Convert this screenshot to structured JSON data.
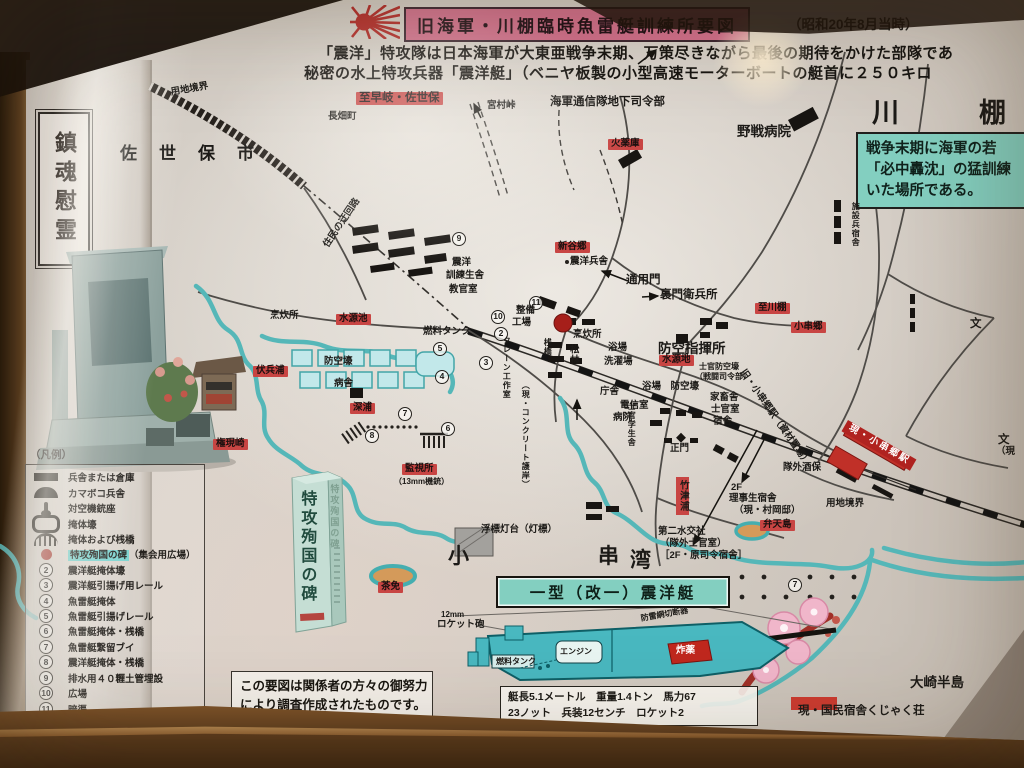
{
  "header": {
    "title": "旧海軍・川棚臨時魚雷艇訓練所要図",
    "date_note": "（昭和20年8月当時）",
    "intro_line1": "「震洋」特攻隊は日本海軍が大東亜戦争末期、万策尽きながら最後の期待をかけた部隊であ",
    "intro_line2": "秘密の水上特攻兵器「震洋艇」（ベニヤ板製の小型高速モーターボートの艇首に２５０キロ",
    "flag_icon": "rising-sun-icon"
  },
  "left_panel": {
    "plaque": "鎮魂慰霊"
  },
  "info_box": {
    "lines": [
      "戦争末期に海軍の若",
      "「必中轟沈」の猛訓練",
      "いた場所である。"
    ]
  },
  "legend": {
    "title": "（凡例）",
    "items": [
      {
        "icon": "ic-bar",
        "label": "兵舎または倉庫"
      },
      {
        "icon": "ic-arc",
        "label": "カマボコ兵舎"
      },
      {
        "icon": "ic-gun",
        "label": "対空機銃座"
      },
      {
        "icon": "ic-bunker",
        "label": "掩体壕"
      },
      {
        "icon": "ic-pier",
        "label": "掩体および桟橋"
      },
      {
        "icon": "ic-reddot",
        "label": "特攻殉国の碑",
        "suffix": "（集会用広場）",
        "highlight": true
      },
      {
        "num": "2",
        "label": "震洋艇掩体壕"
      },
      {
        "num": "3",
        "label": "震洋艇引揚げ用レール"
      },
      {
        "num": "4",
        "label": "魚雷艇掩体"
      },
      {
        "num": "5",
        "label": "魚雷艇引揚げレール"
      },
      {
        "num": "6",
        "label": "魚雷艇掩体・桟橋"
      },
      {
        "num": "7",
        "label": "魚雷艇繋留ブイ"
      },
      {
        "num": "8",
        "label": "震洋艇掩体・桟橋"
      },
      {
        "num": "9",
        "label": "排水用４０糎土管埋設"
      },
      {
        "num": "10",
        "label": "広場"
      },
      {
        "num": "11",
        "label": "暗渠"
      }
    ]
  },
  "map": {
    "accent_colors": {
      "red_label": "#c84543",
      "teal_water": "#55b7b8",
      "green_box": "#83cfc0",
      "title_pink": "#d4718d"
    },
    "labels": [
      {
        "t": "用地境界",
        "x": 170,
        "y": 88,
        "c": "xs",
        "r": -10
      },
      {
        "t": "長畑町",
        "x": 328,
        "y": 112,
        "c": "xs"
      },
      {
        "t": "至早岐・佐世保",
        "x": 356,
        "y": 92,
        "c": "red sm"
      },
      {
        "t": "宮村峠",
        "x": 487,
        "y": 101,
        "c": "xs"
      },
      {
        "t": "佐世保市",
        "x": 120,
        "y": 144,
        "c": "sp1"
      },
      {
        "t": "海軍通信隊地下司令部",
        "x": 550,
        "y": 96,
        "c": "sm"
      },
      {
        "t": "火薬庫",
        "x": 608,
        "y": 139,
        "c": "red xs"
      },
      {
        "t": "野戦病院",
        "x": 737,
        "y": 124,
        "c": "md"
      },
      {
        "t": "川棚",
        "x": 872,
        "y": 98,
        "c": "sp2"
      },
      {
        "t": "施設兵宿舎",
        "x": 851,
        "y": 202,
        "c": "vert xxs"
      },
      {
        "t": "住民の迂回路",
        "x": 322,
        "y": 244,
        "c": "xs",
        "r": -56
      },
      {
        "t": "9",
        "x": 452,
        "y": 232,
        "c": "circ"
      },
      {
        "t": "新谷郷",
        "x": 555,
        "y": 242,
        "c": "red xs"
      },
      {
        "t": "震洋兵舎",
        "x": 570,
        "y": 257,
        "c": "xs"
      },
      {
        "t": "震洋",
        "x": 452,
        "y": 258,
        "c": "xs"
      },
      {
        "t": "訓練生舎",
        "x": 446,
        "y": 271,
        "c": "xs"
      },
      {
        "t": "教官室",
        "x": 449,
        "y": 285,
        "c": "xs"
      },
      {
        "t": "通用門",
        "x": 626,
        "y": 274,
        "c": "sm"
      },
      {
        "t": "裏門衛兵所",
        "x": 660,
        "y": 289,
        "c": "sm"
      },
      {
        "t": "11",
        "x": 529,
        "y": 296,
        "c": "circ"
      },
      {
        "t": "整備",
        "x": 516,
        "y": 306,
        "c": "xs"
      },
      {
        "t": "工場",
        "x": 512,
        "y": 318,
        "c": "xs"
      },
      {
        "t": "10",
        "x": 491,
        "y": 310,
        "c": "circ"
      },
      {
        "t": "燃料タンク",
        "x": 423,
        "y": 327,
        "c": "xs"
      },
      {
        "t": "5",
        "x": 433,
        "y": 342,
        "c": "circ"
      },
      {
        "t": "2",
        "x": 494,
        "y": 327,
        "c": "circ"
      },
      {
        "t": "3",
        "x": 479,
        "y": 356,
        "c": "circ"
      },
      {
        "t": "4",
        "x": 435,
        "y": 370,
        "c": "circ"
      },
      {
        "t": "クレーン工作室",
        "x": 502,
        "y": 336,
        "c": "vert xxs"
      },
      {
        "t": "桟橋",
        "x": 543,
        "y": 338,
        "c": "vert xxs"
      },
      {
        "t": "松林",
        "x": 567,
        "y": 344,
        "c": "vert xs"
      },
      {
        "t": "（現・コンクリート護岸）",
        "x": 521,
        "y": 381,
        "c": "vert xxs"
      },
      {
        "t": "烹炊所",
        "x": 270,
        "y": 311,
        "c": "xs"
      },
      {
        "t": "水源池",
        "x": 336,
        "y": 314,
        "c": "red xs"
      },
      {
        "t": "伏兵浦",
        "x": 253,
        "y": 366,
        "c": "red xs"
      },
      {
        "t": "防空壕",
        "x": 324,
        "y": 357,
        "c": "xs"
      },
      {
        "t": "病舎",
        "x": 334,
        "y": 379,
        "c": "xs"
      },
      {
        "t": "深浦",
        "x": 350,
        "y": 403,
        "c": "red xs"
      },
      {
        "t": "権現崎",
        "x": 213,
        "y": 439,
        "c": "red xs"
      },
      {
        "t": "烹炊所",
        "x": 573,
        "y": 330,
        "c": "xs"
      },
      {
        "t": "浴場",
        "x": 608,
        "y": 343,
        "c": "xs"
      },
      {
        "t": "洗濯場",
        "x": 604,
        "y": 357,
        "c": "xs"
      },
      {
        "t": "防空指揮所",
        "x": 658,
        "y": 341,
        "c": "md"
      },
      {
        "t": "水源地",
        "x": 659,
        "y": 355,
        "c": "red xs"
      },
      {
        "t": "士官防空壕",
        "x": 699,
        "y": 362,
        "c": "xxs"
      },
      {
        "t": "（戦闘司令部）",
        "x": 695,
        "y": 372,
        "c": "xxs"
      },
      {
        "t": "浴場　防空壕",
        "x": 642,
        "y": 382,
        "c": "xs"
      },
      {
        "t": "庁舎",
        "x": 600,
        "y": 387,
        "c": "xs"
      },
      {
        "t": "電信室",
        "x": 620,
        "y": 401,
        "c": "xs"
      },
      {
        "t": "病院",
        "x": 613,
        "y": 413,
        "c": "xs"
      },
      {
        "t": "家畜舎",
        "x": 710,
        "y": 393,
        "c": "xs"
      },
      {
        "t": "士官室",
        "x": 711,
        "y": 405,
        "c": "xs"
      },
      {
        "t": "宿舎",
        "x": 713,
        "y": 417,
        "c": "xs"
      },
      {
        "t": "士官学生舎",
        "x": 627,
        "y": 402,
        "c": "vert xxs"
      },
      {
        "t": "正門",
        "x": 670,
        "y": 444,
        "c": "xs"
      },
      {
        "t": "7",
        "x": 398,
        "y": 407,
        "c": "circ"
      },
      {
        "t": "8",
        "x": 365,
        "y": 429,
        "c": "circ"
      },
      {
        "t": "6",
        "x": 441,
        "y": 422,
        "c": "circ"
      },
      {
        "t": "監視所",
        "x": 402,
        "y": 464,
        "c": "red xs"
      },
      {
        "t": "（13mm機銃）",
        "x": 394,
        "y": 477,
        "c": "xxs"
      },
      {
        "t": "浮標灯台（灯標）",
        "x": 481,
        "y": 525,
        "c": "xs"
      },
      {
        "t": "小",
        "x": 448,
        "y": 545,
        "c": "lg"
      },
      {
        "t": "串",
        "x": 598,
        "y": 545,
        "c": "lg"
      },
      {
        "t": "湾",
        "x": 630,
        "y": 549,
        "c": "lg"
      },
      {
        "t": "竹津浦",
        "x": 676,
        "y": 477,
        "c": "vert red-v xs"
      },
      {
        "t": "第二水交社",
        "x": 658,
        "y": 527,
        "c": "xs"
      },
      {
        "t": "（隊外士官室）",
        "x": 660,
        "y": 539,
        "c": "xs"
      },
      {
        "t": "［2F・原司令宿舎］",
        "x": 660,
        "y": 551,
        "c": "xs"
      },
      {
        "t": "2F",
        "x": 731,
        "y": 483,
        "c": "xs"
      },
      {
        "t": "理事生宿舎",
        "x": 729,
        "y": 494,
        "c": "xs"
      },
      {
        "t": "（現・村岡邸）",
        "x": 734,
        "y": 506,
        "c": "xs"
      },
      {
        "t": "弁天島",
        "x": 760,
        "y": 520,
        "c": "red xs"
      },
      {
        "t": "隊外酒保",
        "x": 783,
        "y": 463,
        "c": "xs"
      },
      {
        "t": "旧・小串郷駅（資材置場）",
        "x": 746,
        "y": 368,
        "c": "xs",
        "r": 55
      },
      {
        "t": "現・小串郷駅",
        "x": 848,
        "y": 420,
        "c": "redband xs",
        "r": 30
      },
      {
        "t": "小串郷",
        "x": 791,
        "y": 322,
        "c": "red xs"
      },
      {
        "t": "至川棚",
        "x": 755,
        "y": 303,
        "c": "red xs"
      },
      {
        "t": "文",
        "x": 970,
        "y": 318,
        "c": "sm"
      },
      {
        "t": "文",
        "x": 998,
        "y": 434,
        "c": "sm"
      },
      {
        "t": "（現",
        "x": 996,
        "y": 447,
        "c": "xs"
      },
      {
        "t": "用地境界",
        "x": 826,
        "y": 499,
        "c": "xs"
      },
      {
        "t": "茶免",
        "x": 378,
        "y": 582,
        "c": "red xs"
      },
      {
        "t": "7",
        "x": 788,
        "y": 578,
        "c": "circ"
      },
      {
        "t": "大崎半島",
        "x": 910,
        "y": 675,
        "c": "md"
      },
      {
        "t": "現・国民宿舎くじゃく荘",
        "x": 798,
        "y": 705,
        "c": "sm"
      },
      {
        "t": "特攻殉国の碑",
        "x": 297,
        "y": 490,
        "c": "vert stele-front"
      },
      {
        "t": "特攻殉国の碑",
        "x": 329,
        "y": 484,
        "c": "vert stele-side"
      }
    ]
  },
  "boat": {
    "title": "一型（改一）震洋艇",
    "labels": [
      {
        "t": "12mm",
        "x": 441,
        "y": 610,
        "c": "xxs"
      },
      {
        "t": "ロケット砲",
        "x": 437,
        "y": 620,
        "c": "xs"
      },
      {
        "t": "防雷網切断器",
        "x": 640,
        "y": 614,
        "c": "xxs",
        "r": -10
      },
      {
        "t": "エンジン",
        "x": 560,
        "y": 647,
        "c": "xxs"
      },
      {
        "t": "燃料タンク",
        "x": 496,
        "y": 657,
        "c": "xxs"
      },
      {
        "t": "炸薬",
        "x": 676,
        "y": 646,
        "c": "wh xs"
      }
    ],
    "specs": [
      "艇長5.1メートル　重量1.4トン　馬力67",
      "23ノット　兵装12センチ　ロケット2"
    ]
  },
  "note_box": {
    "lines": [
      "この要図は関係者の方々の御努力",
      "により調査作成されたものです。"
    ]
  }
}
